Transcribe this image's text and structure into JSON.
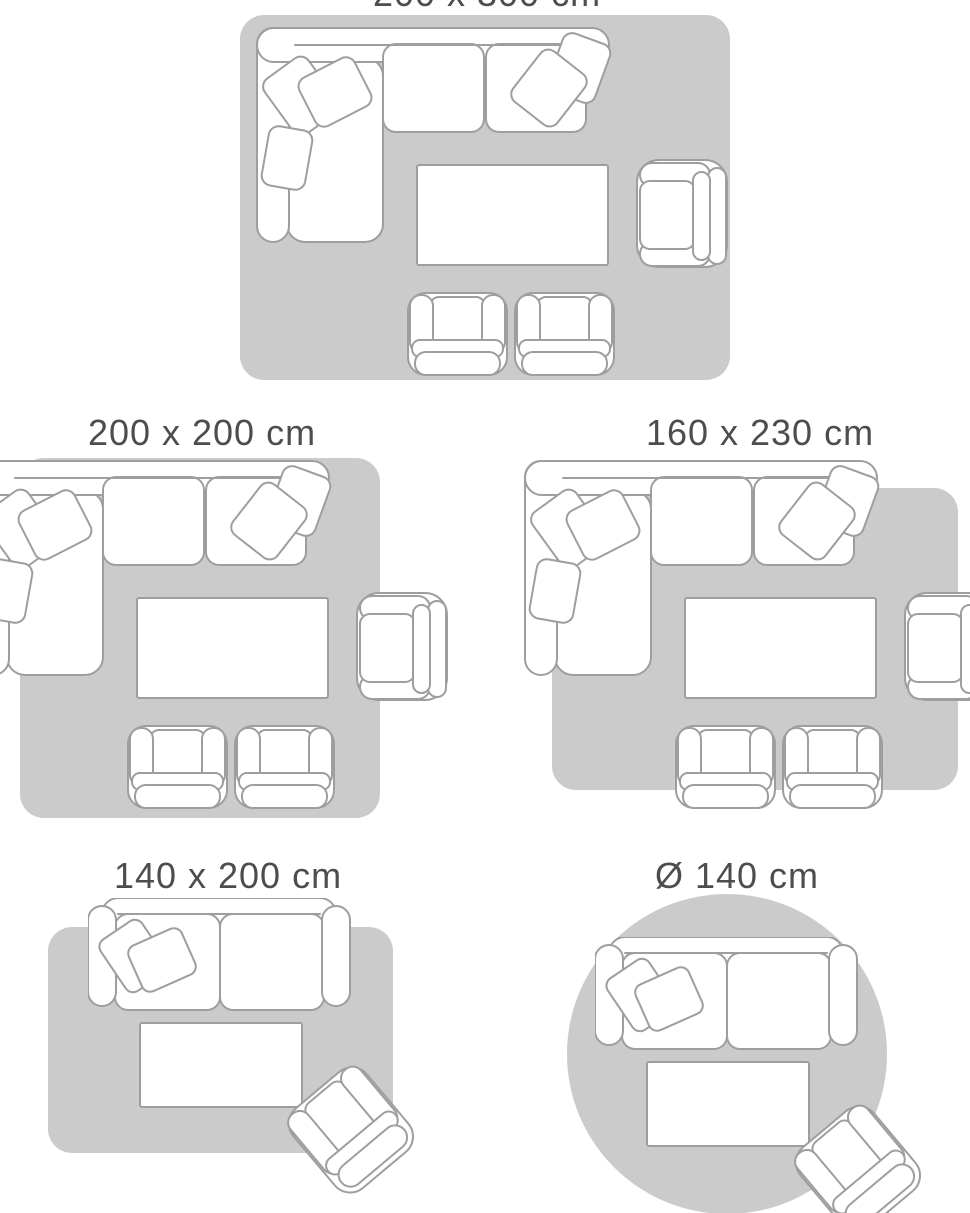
{
  "page": {
    "type": "rug-size-guide"
  },
  "colors": {
    "background": "#ffffff",
    "rug": "#cbcbcb",
    "furniture_fill": "#ffffff",
    "furniture_stroke": "#9e9e9e",
    "title_text": "#4d4d4d"
  },
  "panels": [
    {
      "id": "rug-200x300",
      "title": "200 x 300 cm",
      "rug_shape": "rectangle",
      "scene": "living-room-large"
    },
    {
      "id": "rug-200x200",
      "title": "200 x 200 cm",
      "rug_shape": "square",
      "scene": "living-room-large"
    },
    {
      "id": "rug-160x230",
      "title": "160 x 230 cm",
      "rug_shape": "rectangle",
      "scene": "living-room-large"
    },
    {
      "id": "rug-140x200",
      "title": "140 x 200 cm",
      "rug_shape": "rectangle",
      "scene": "living-room-small"
    },
    {
      "id": "rug-d140",
      "title": "Ø 140 cm",
      "rug_shape": "circle",
      "scene": "living-room-small"
    }
  ],
  "scenes": {
    "living-room-large": {
      "items": [
        "corner-sofa",
        "throw-pillows",
        "coffee-table",
        "armchair-right",
        "armchair-bottom",
        "armchair-bottom"
      ]
    },
    "living-room-small": {
      "items": [
        "two-seat-sofa",
        "throw-pillows",
        "coffee-table",
        "tilted-armchair"
      ]
    }
  }
}
